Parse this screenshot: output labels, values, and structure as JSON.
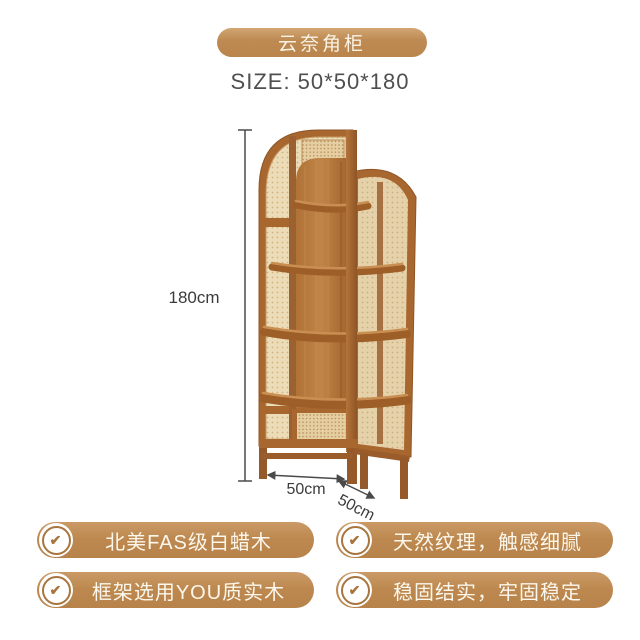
{
  "header": {
    "title_badge": "云奈角柜",
    "size_label": "SIZE: 50*50*180"
  },
  "product": {
    "name": "corner cabinet (wood frame with rattan panels, 4 shelves)",
    "dimensions": {
      "height": "180cm",
      "width": "50cm",
      "depth": "50cm"
    }
  },
  "features": [
    {
      "icon": "check-icon",
      "label": "北美FAS级白蜡木"
    },
    {
      "icon": "check-icon",
      "label": "天然纹理，触感细腻"
    },
    {
      "icon": "check-icon",
      "label": "框架选用YOU质实木"
    },
    {
      "icon": "check-icon",
      "label": "稳固结实，牢固稳定"
    }
  ],
  "colors": {
    "accent_brown": "#bd8950",
    "frame_wood": "#a8672f",
    "back_wood": "#b5793f",
    "rattan": "#ecdcb8",
    "dimension_text": "#3c3c3c",
    "size_text": "#4f4f4f",
    "badge_text": "#fcf7ec",
    "background": "#ffffff"
  }
}
